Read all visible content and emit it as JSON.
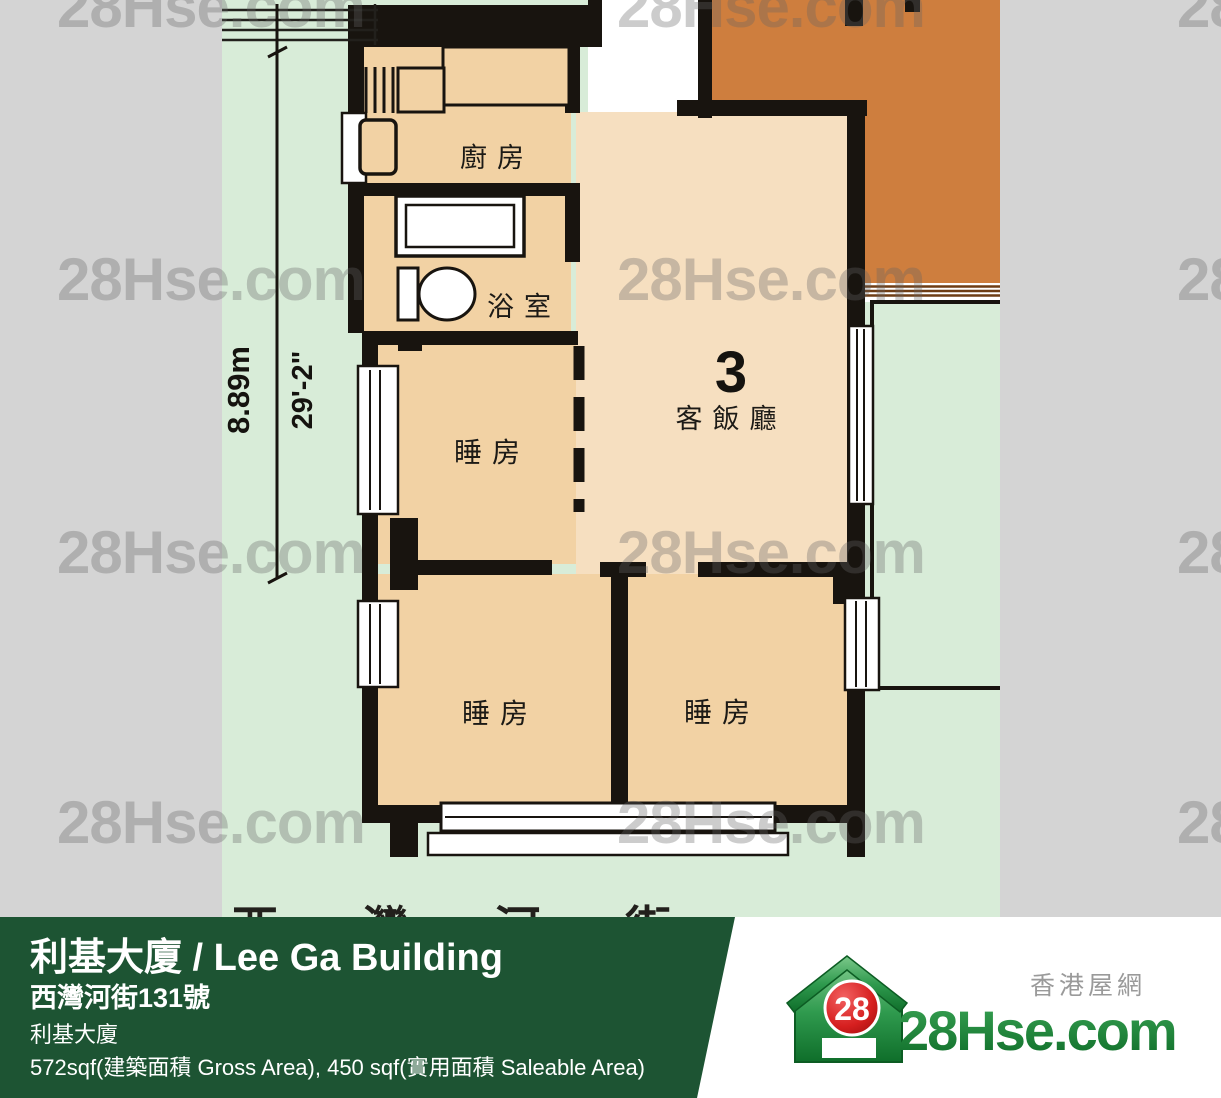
{
  "plan": {
    "rooms": {
      "kitchen": "廚房",
      "bathroom": "浴室",
      "bedroom1": "睡房",
      "bedroom2": "睡房",
      "bedroom3": "睡房",
      "living_unit_number": "3",
      "living": "客飯廳"
    },
    "dimensions": {
      "metric": "8.89m",
      "imperial": "29'-2\""
    },
    "street_text_partial": "西灣河街"
  },
  "watermark": {
    "text": "28Hse.com"
  },
  "banner": {
    "title": "利基大廈 / Lee Ga Building",
    "address": "西灣河街131號",
    "building": "利基大廈",
    "area": "572sqf(建築面積 Gross Area), 450 sqf(實用面積 Saleable Area)"
  },
  "logo": {
    "brand": "28Hse.com",
    "badge": "28",
    "tagline": "香港屋網"
  },
  "colors": {
    "banner_green": "#1d5433",
    "logo_green": "#1f8b3a",
    "badge_red": "#c41414",
    "plan_background": "#d8ecd8",
    "room_fill": "#f2d2a4",
    "living_fill": "#f6dfc0",
    "adjacent_unit_orange": "#ce7e3e",
    "wall_black": "#18140f",
    "margin_gray": "#d4d4d4"
  }
}
